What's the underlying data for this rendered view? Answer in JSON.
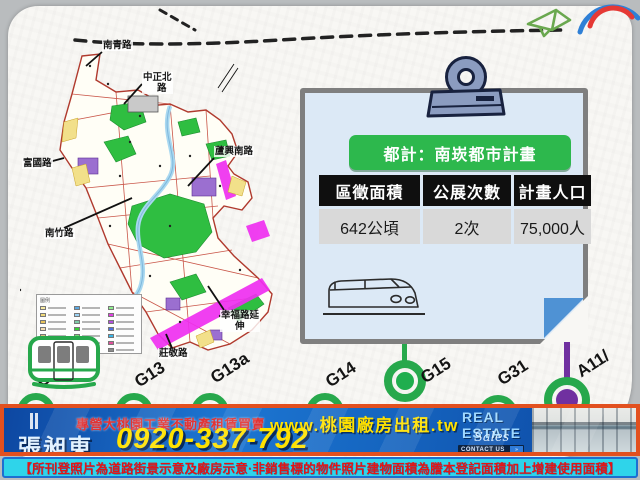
{
  "map": {
    "labels": [
      {
        "line1": "南青路"
      },
      {
        "line1": "中正北",
        "line2": "路"
      },
      {
        "line1": "富國路"
      },
      {
        "line1": "蘆興南路"
      },
      {
        "line1": "南竹路"
      },
      {
        "line1": "幸福路延",
        "line2": "伸"
      },
      {
        "line1": "莊敬路"
      }
    ],
    "legend_title": "圖例",
    "legend_colors": [
      "#f7e9a0",
      "#5aa7e0",
      "#8ff08f",
      "#f0d97a",
      "#9bd3f5",
      "#e23ee2",
      "#e8c35a",
      "#7ec9a8",
      "#b44fe0",
      "#f5deb3",
      "#34d134",
      "#4f6fe0",
      "#d9c27e",
      "#6fe06f",
      "#3ab5e8",
      "#c9b26a",
      "#37c9e8",
      "#e04f9b",
      "#efe3c0",
      "#e84fd4",
      "#8a8a8a"
    ]
  },
  "clipboard": {
    "badge": "都計：南崁都市計畫",
    "table": {
      "headers": [
        "區徵面積",
        "公展次數",
        "計畫人口"
      ],
      "row": [
        "642公頃",
        "2次",
        "75,000人"
      ]
    }
  },
  "stations": [
    {
      "id": "G12",
      "color": "#27a84c"
    },
    {
      "id": "G13",
      "color": "#27a84c"
    },
    {
      "id": "G13a",
      "color": "#27a84c"
    },
    {
      "id": "G14",
      "color": "#27a84c"
    },
    {
      "id": "G15",
      "color": "#27a84c"
    },
    {
      "id": "G31",
      "color": "#27a84c"
    },
    {
      "id": "A11/",
      "color": "#7030a0"
    }
  ],
  "banner": {
    "tagline": "專營大桃園工業不動產租賃買賣",
    "website": "www.桃園廠房出租.tw",
    "agent": "張昶東",
    "phone": "0920-337-792",
    "brand_line1": "REAL",
    "brand_line2": "ESTATE",
    "brand_script": "Sales",
    "contact_label": "CONTACT US",
    "contact_chip": "»"
  },
  "disclaimer": "【所刊登照片為道路街景示意及廠房示意·非銷售標的物件照片建物面積為謄本登記面積加上增建使用面積】",
  "colors": {
    "station_green": "#27a84c",
    "station_purple": "#7030a0",
    "badge_green": "#2db84d",
    "banner_border": "#e2501f",
    "banner_blue": "#1565c0",
    "accent_yellow": "#ffe100",
    "disclaimer_bg": "#2fd4ea",
    "disclaimer_text": "#e31515"
  }
}
